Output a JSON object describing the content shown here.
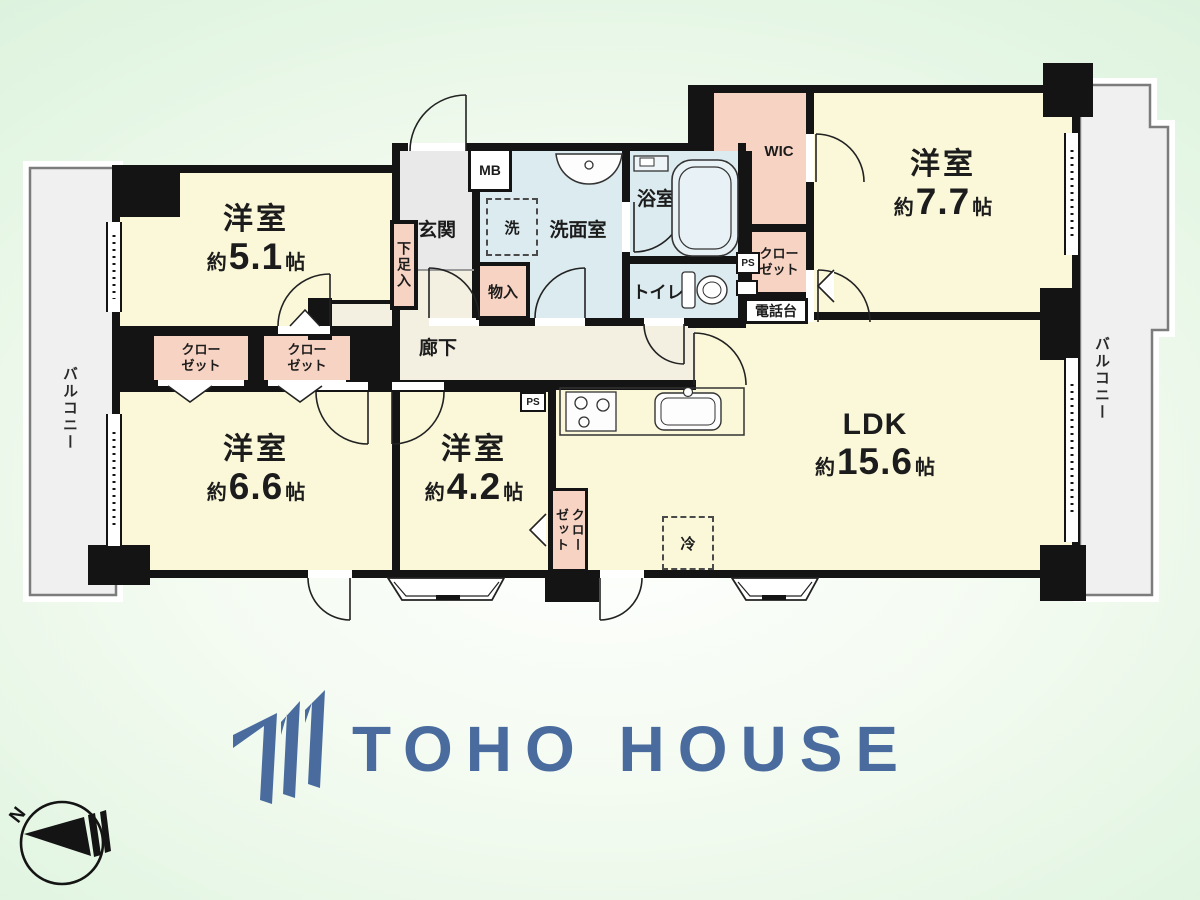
{
  "rooms": {
    "r51": {
      "name": "洋室",
      "approx": "約",
      "size": "5.1",
      "unit": "帖"
    },
    "r77": {
      "name": "洋室",
      "approx": "約",
      "size": "7.7",
      "unit": "帖"
    },
    "r66": {
      "name": "洋室",
      "approx": "約",
      "size": "6.6",
      "unit": "帖"
    },
    "r42": {
      "name": "洋室",
      "approx": "約",
      "size": "4.2",
      "unit": "帖"
    },
    "ldk": {
      "name": "LDK",
      "approx": "約",
      "size": "15.6",
      "unit": "帖"
    }
  },
  "labels": {
    "genkan": "玄関",
    "hallway": "廊下",
    "washroom": "洗面室",
    "bathroom": "浴室",
    "toilet": "トイレ",
    "wic": "WIC",
    "closet_l1": "クロー",
    "closet_l2": "ゼット",
    "shoe_cabinet": "下足入",
    "storage": "物入",
    "phone_stand": "電話台",
    "meter_box": "MB",
    "pipe_space": "PS",
    "washer": "洗",
    "fridge": "冷",
    "balcony": "バルコニー"
  },
  "logo": {
    "text": "TOHO HOUSE"
  },
  "compass": {
    "north": "N"
  },
  "colors": {
    "logo_blue": "#4a6b9d",
    "room_yellow": "#fbf8da",
    "closet_pink": "#f7d3c3",
    "wet_blue": "#dcebf0",
    "hall_beige": "#f3efe1",
    "entrance_gray": "#e9e9e9",
    "balcony_gray": "#f0f0f0",
    "wall_black": "#141414",
    "background_green": "#d9f2db"
  }
}
